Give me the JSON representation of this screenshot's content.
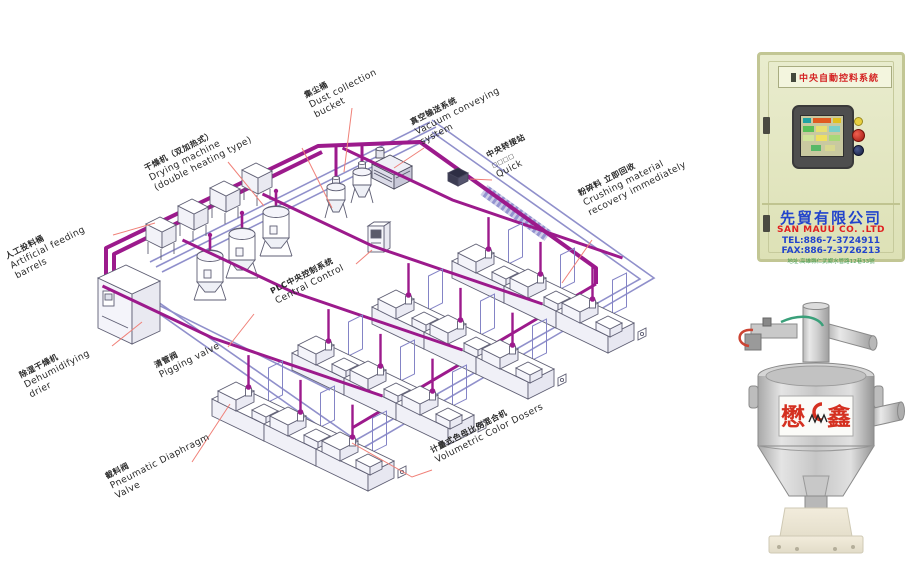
{
  "diagram": {
    "labels": {
      "feeding_barrels": {
        "zh": "人工投料桶",
        "en1": "Artificial feeding",
        "en2": "barrels"
      },
      "drying_machine": {
        "zh": "干燥机（双加热式）",
        "en1": "Drying machine",
        "en2": "(double heating type)"
      },
      "dust_bucket": {
        "zh": "集尘桶",
        "en1": "Dust collection",
        "en2": "bucket"
      },
      "vacuum_system": {
        "zh": "真空输送系统",
        "en1": "Vacuum conveying",
        "en2": "system"
      },
      "transfer_station": {
        "zh": "中央转接站",
        "en1": "□□□□",
        "en2": "Quick"
      },
      "crushing_recovery": {
        "zh": "粉碎料 立即回收",
        "en1": "Crushing material",
        "en2": "recovery immediately"
      },
      "plc_control": {
        "zh": "PLC中央控制系统",
        "en1": "Central Control",
        "en2": ""
      },
      "dehumidifying_dryer": {
        "zh": "除湿干燥机",
        "en1": "Dehumidifying",
        "en2": "drier"
      },
      "pigging_valve": {
        "zh": "清管阀",
        "en1": "Pigging valve",
        "en2": ""
      },
      "pneumatic_valve": {
        "zh": "截料阀",
        "en1": "Pneumatic Diaphragm",
        "en2": "Valve"
      },
      "volumetric_dosers": {
        "zh": "计量式色母比例混合机",
        "en1": "Volumetric Color Dosers",
        "en2": ""
      }
    },
    "machine_grid": {
      "rows": 4,
      "cols": 3
    },
    "colors": {
      "pipe_magenta": "#9c1a8c",
      "pipe_blue": "#8484c6",
      "leader_red": "#f08078"
    }
  },
  "control_panel": {
    "sign": "中央自動控料系統",
    "company_zh": "先貿有限公司",
    "company_en": "SAN MAUU CO. .LTD",
    "tel": "TEL:886-7-3724911",
    "fax": "FAX:886-7-3726213",
    "address": "地址:高雄縣仁武鄉水管路12巷33號"
  },
  "hopper_unit": {
    "brand_left": "懋",
    "brand_right": "鑫"
  }
}
